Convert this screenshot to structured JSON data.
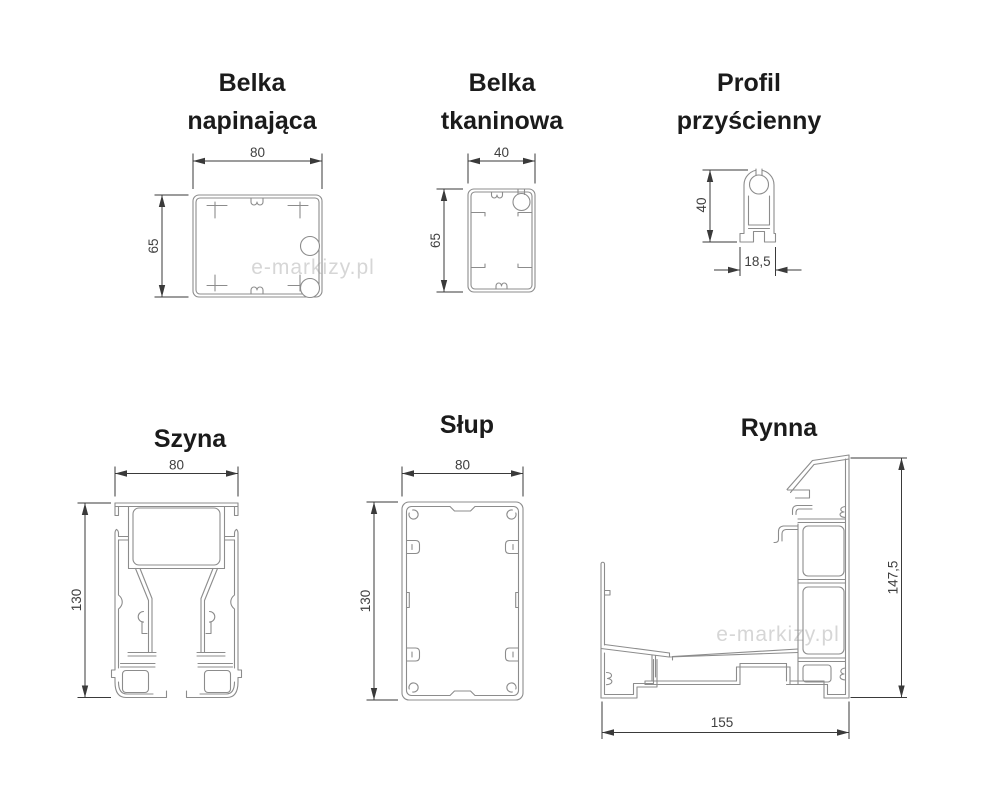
{
  "page": {
    "background": "#ffffff"
  },
  "watermark": {
    "text": "e-markizy.pl",
    "color": "#cfcfcf"
  },
  "colors": {
    "profile_outline": "#8c8c8c",
    "dimension_lines": "#3a3a3a",
    "dimension_text": "#3f3f3f",
    "title_text": "#1b1b1b"
  },
  "profiles": [
    {
      "name": "belka-napinajaca",
      "title": [
        "Belka",
        "napinająca"
      ],
      "width_label": "80",
      "height_label": "65"
    },
    {
      "name": "belka-tkaninowa",
      "title": [
        "Belka",
        "tkaninowa"
      ],
      "width_label": "40",
      "height_label": "65"
    },
    {
      "name": "profil-przyscienny",
      "title": [
        "Profil",
        "przyścienny"
      ],
      "height_label": "40",
      "bottom_width_label": "18,5"
    },
    {
      "name": "szyna",
      "title": [
        "Szyna"
      ],
      "width_label": "80",
      "height_label": "130"
    },
    {
      "name": "slup",
      "title": [
        "Słup"
      ],
      "width_label": "80",
      "height_label": "130"
    },
    {
      "name": "rynna",
      "title": [
        "Rynna"
      ],
      "height_label": "147,5",
      "bottom_width_label": "155"
    }
  ]
}
